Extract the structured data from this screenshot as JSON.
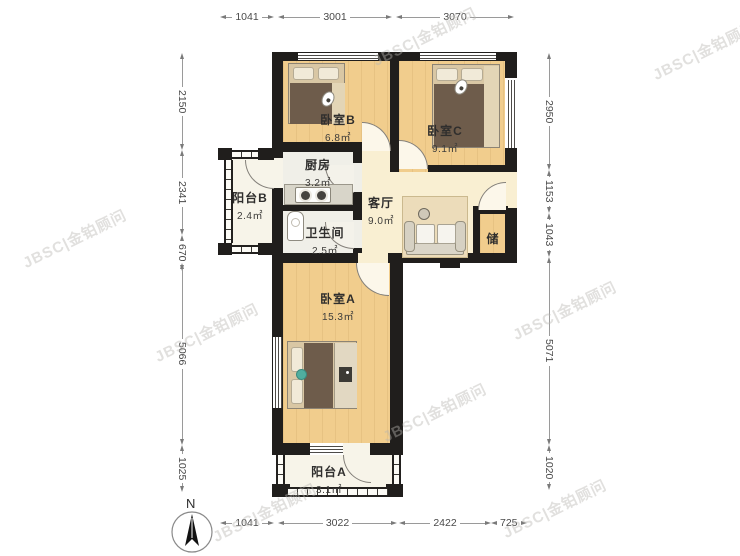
{
  "watermark": {
    "text": "JBSC|金铂顾问"
  },
  "compass": {
    "label": "N"
  },
  "dims": {
    "top": [
      "1041",
      "3001",
      "3070"
    ],
    "bottom": [
      "1041",
      "3022",
      "2422",
      "725"
    ],
    "left": [
      "2150",
      "2341",
      "670",
      "5066",
      "1025"
    ],
    "right": [
      "2950",
      "1153",
      "1043",
      "5071",
      "1020"
    ]
  },
  "rooms": {
    "bedroomB": {
      "name": "卧室B",
      "area": "6.8㎡"
    },
    "bedroomC": {
      "name": "卧室C",
      "area": "9.1㎡"
    },
    "kitchen": {
      "name": "厨房",
      "area": "3.2㎡"
    },
    "balconyB": {
      "name": "阳台B",
      "area": "2.4㎡"
    },
    "bathroom": {
      "name": "卫生间",
      "area": "2.5㎡"
    },
    "living": {
      "name": "客厅",
      "area": "9.0㎡"
    },
    "storage": {
      "name": "储"
    },
    "bedroomA": {
      "name": "卧室A",
      "area": "15.3㎡"
    },
    "balconyA": {
      "name": "阳台A",
      "area": "3.1㎡"
    }
  },
  "colors": {
    "wall": "#201e1c",
    "wood_floor": "#f1cd8d",
    "living_floor": "#f9efd2",
    "wet_floor": "#f0efe8",
    "duvet_brown": "#6e5c4b",
    "accent_teal": "#4fae9f"
  }
}
